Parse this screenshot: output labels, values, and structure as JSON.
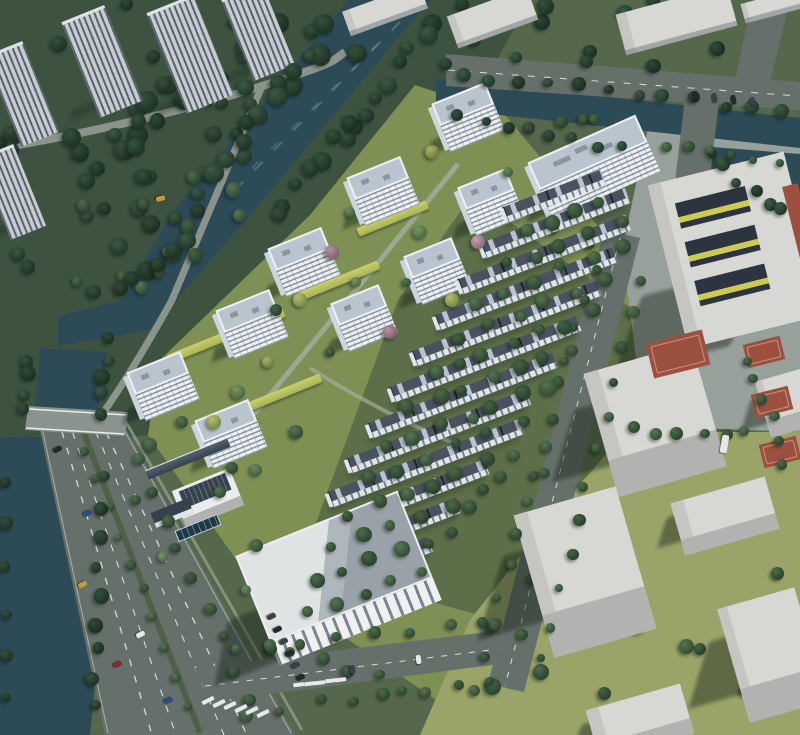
{
  "meta": {
    "type": "architectural aerial rendering",
    "subject": "bird's-eye view of a riverside residential development with high-rise towers, townhouse rows and surrounding context buildings",
    "visible_text": "none"
  },
  "palette": {
    "base": "#55684c",
    "forest": "#3d5340",
    "lawn": "#7f9054",
    "lawn_dark": "#5c6f48",
    "grass_pale": "#9aa468",
    "plaza": "#98a09b",
    "water": "#2d4a57",
    "road": "#66706b",
    "road_light": "#8b938e",
    "path": "#8a938c",
    "site_path": "#a3ab9c",
    "lane_mark": "#d8dcd9",
    "median_green": "#4e6047",
    "tower_facade": "#edf0f2",
    "tower_stripe": "#8a95a1",
    "tower_roof": "#b9c4ce",
    "tower_side": "#cdd5dc",
    "context_facade": "#c6ccd1",
    "context_stripe": "#5a646d",
    "block_top": "#d7d7d4",
    "block_front": "#b2b3b0",
    "block_side": "#c5c5c2",
    "shadow": "rgba(22,36,24,0.45)",
    "row_roof": "#49525e",
    "row_skylight": "#b7c4cf",
    "row_facade": "#dfe5e9",
    "court_red": "#9c5040",
    "court_line": "#c9937f",
    "school_court_dark": "#2c3440",
    "school_accent": "#ccca52",
    "pool": "#1d3945",
    "solar": "#36424e",
    "trees": {
      "dark": [
        [
          "#3b5a44",
          "#22382a"
        ],
        [
          "#34513d",
          "#1e3226"
        ],
        [
          "#2f4a38",
          "#1b2e22"
        ]
      ],
      "mid": [
        [
          "#4d6c4a",
          "#2c4430"
        ],
        [
          "#567552",
          "#314c36"
        ],
        [
          "#466246",
          "#28402d"
        ]
      ],
      "light": [
        [
          "#6d8a5e",
          "#41603f"
        ],
        [
          "#7a955f",
          "#4a6a42"
        ]
      ],
      "accent": [
        [
          "#a8b168",
          "#6f7d3f"
        ],
        [
          "#b6bd72",
          "#7c8948"
        ]
      ],
      "pink": [
        [
          "#c2a3ae",
          "#8d6a78"
        ],
        [
          "#b593a2",
          "#82606f"
        ]
      ]
    },
    "cars": [
      "#23282f",
      "#2f4d85",
      "#c49b35",
      "#7c2f2f",
      "#e8e8e8",
      "#3a4148"
    ]
  },
  "scene": {
    "counts": {
      "residential_towers": 9,
      "residential_slab_towers": 1,
      "townhouse_rows": 12,
      "context_towers": 5,
      "context_blocks": 6,
      "context_slabs": 4,
      "sports_courts": 4,
      "bridges": 1
    },
    "features": [
      "river-canal",
      "northeast-pond",
      "main-boulevard-with-bridge",
      "zebra-crosswalks",
      "tower-garden-landscaping",
      "yellow-hedge-strips",
      "townhouse-rows-with-skylights",
      "school-with-courtyards",
      "basketball-court",
      "commercial-building",
      "community-center-with-solar-panels",
      "swimming-pool",
      "tree-lined-streets",
      "parked-cars"
    ]
  }
}
